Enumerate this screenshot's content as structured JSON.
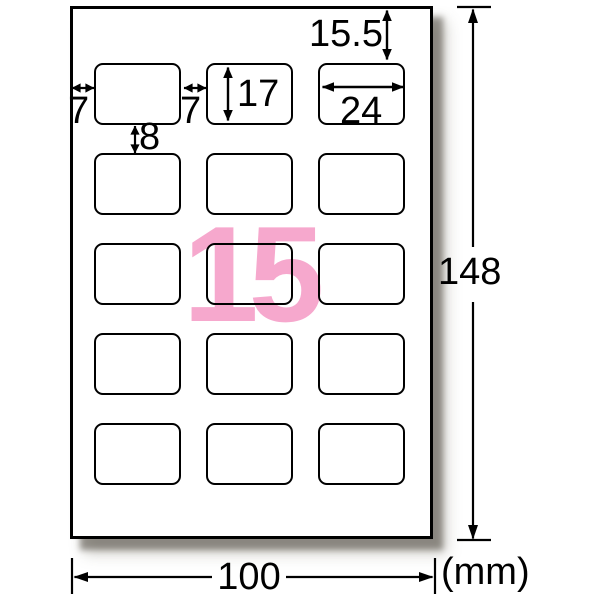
{
  "sheet": {
    "count_label": "15",
    "grid": {
      "rows": 5,
      "cols": 3
    }
  },
  "dims": {
    "top_margin": "15.5",
    "left_margin": "7",
    "column_gap": "7",
    "row_gap": "8",
    "label_height": "17",
    "label_width": "24",
    "sheet_height": "148",
    "sheet_width": "100",
    "unit": "(mm)"
  },
  "colors": {
    "accent_pink": "#f6a8cd",
    "line_black": "#000000"
  }
}
